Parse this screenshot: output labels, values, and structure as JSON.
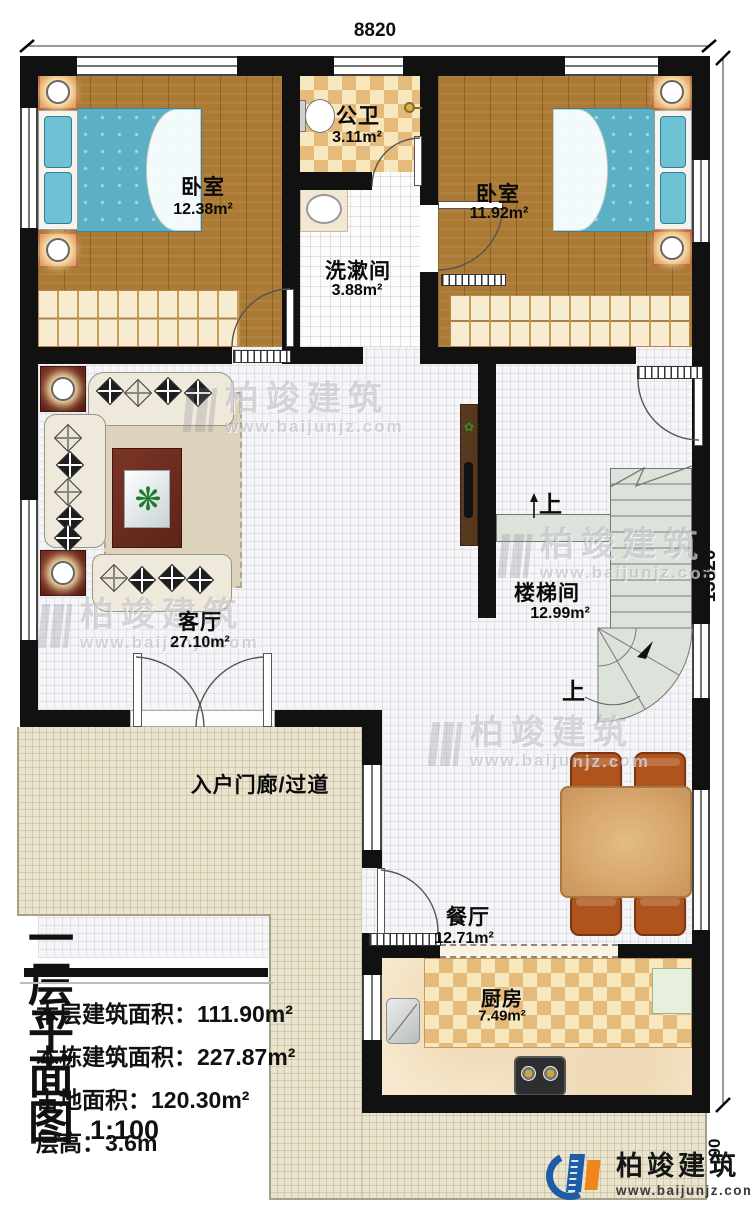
{
  "meta": {
    "drawing_type": "floor-plan"
  },
  "dimensions": {
    "top": "8820",
    "right": "13820",
    "right_partial": "00"
  },
  "rooms": {
    "bedroom_left": {
      "name": "卧室",
      "area": "12.38m²"
    },
    "bathroom": {
      "name": "公卫",
      "area": "3.11m²"
    },
    "bedroom_right": {
      "name": "卧室",
      "area": "11.92m²"
    },
    "washroom": {
      "name": "洗漱间",
      "area": "3.88m²"
    },
    "living": {
      "name": "客厅",
      "area": "27.10m²"
    },
    "stairwell": {
      "name": "楼梯间",
      "area": "12.99m²"
    },
    "porch": {
      "name": "入户门廊/过道"
    },
    "dining": {
      "name": "餐厅",
      "area": "12.71m²"
    },
    "kitchen": {
      "name": "厨房",
      "area": "7.49m²"
    }
  },
  "stairs": {
    "up_label_1": "上",
    "up_label_2": "上"
  },
  "title_block": {
    "title": "一层平面图",
    "scale": "1:100",
    "rows": [
      "本层建筑面积：111.90m²",
      "本栋建筑面积：227.87m²",
      "占地面积：120.30m²",
      "层高：3.6m"
    ]
  },
  "watermark": {
    "name": "柏竣建筑",
    "url": "www.baijunjz.com"
  },
  "logo": {
    "name": "柏竣建筑",
    "url": "www.baijunjz.com"
  },
  "icons": {
    "plant_glyph": "❋",
    "small_plant_glyph": "✿"
  },
  "colors": {
    "wall": "#111111",
    "wood_floor": "#ab7a34",
    "mattress_blue": "#5cb0c6",
    "logo_blue": "#1c5ca8",
    "logo_orange": "#f08519",
    "stair_gray": "#dce3da"
  }
}
